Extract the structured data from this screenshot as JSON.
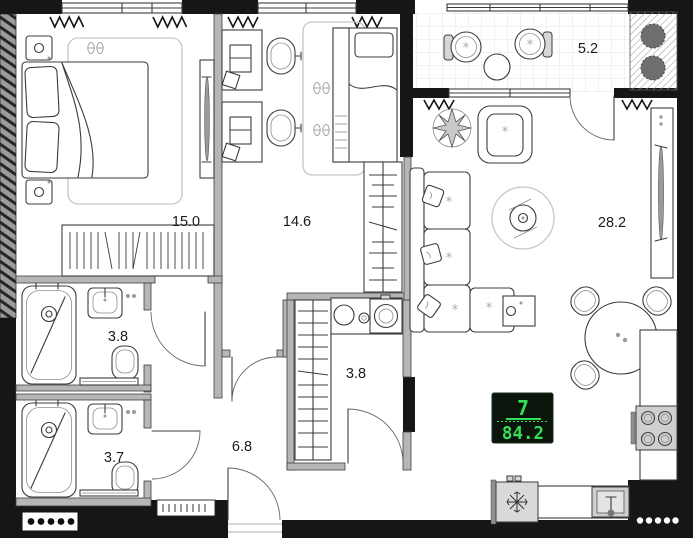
{
  "rooms": [
    {
      "key": "bedroom",
      "area": "15.0"
    },
    {
      "key": "kids_room",
      "area": "14.6"
    },
    {
      "key": "balcony",
      "area": "5.2"
    },
    {
      "key": "living_kitchen",
      "area": "28.2"
    },
    {
      "key": "bathroom_main",
      "area": "3.8"
    },
    {
      "key": "bathroom_laundry",
      "area": "3.8"
    },
    {
      "key": "bathroom_second",
      "area": "3.7"
    },
    {
      "key": "hallway",
      "area": "6.8"
    }
  ],
  "display": {
    "floor": "7",
    "total_area": "84.2"
  },
  "colors": {
    "led_green": "#35df55",
    "led_bg": "#0b150c",
    "wall_black": "#161616",
    "partition_gray": "#b6b6b6"
  }
}
